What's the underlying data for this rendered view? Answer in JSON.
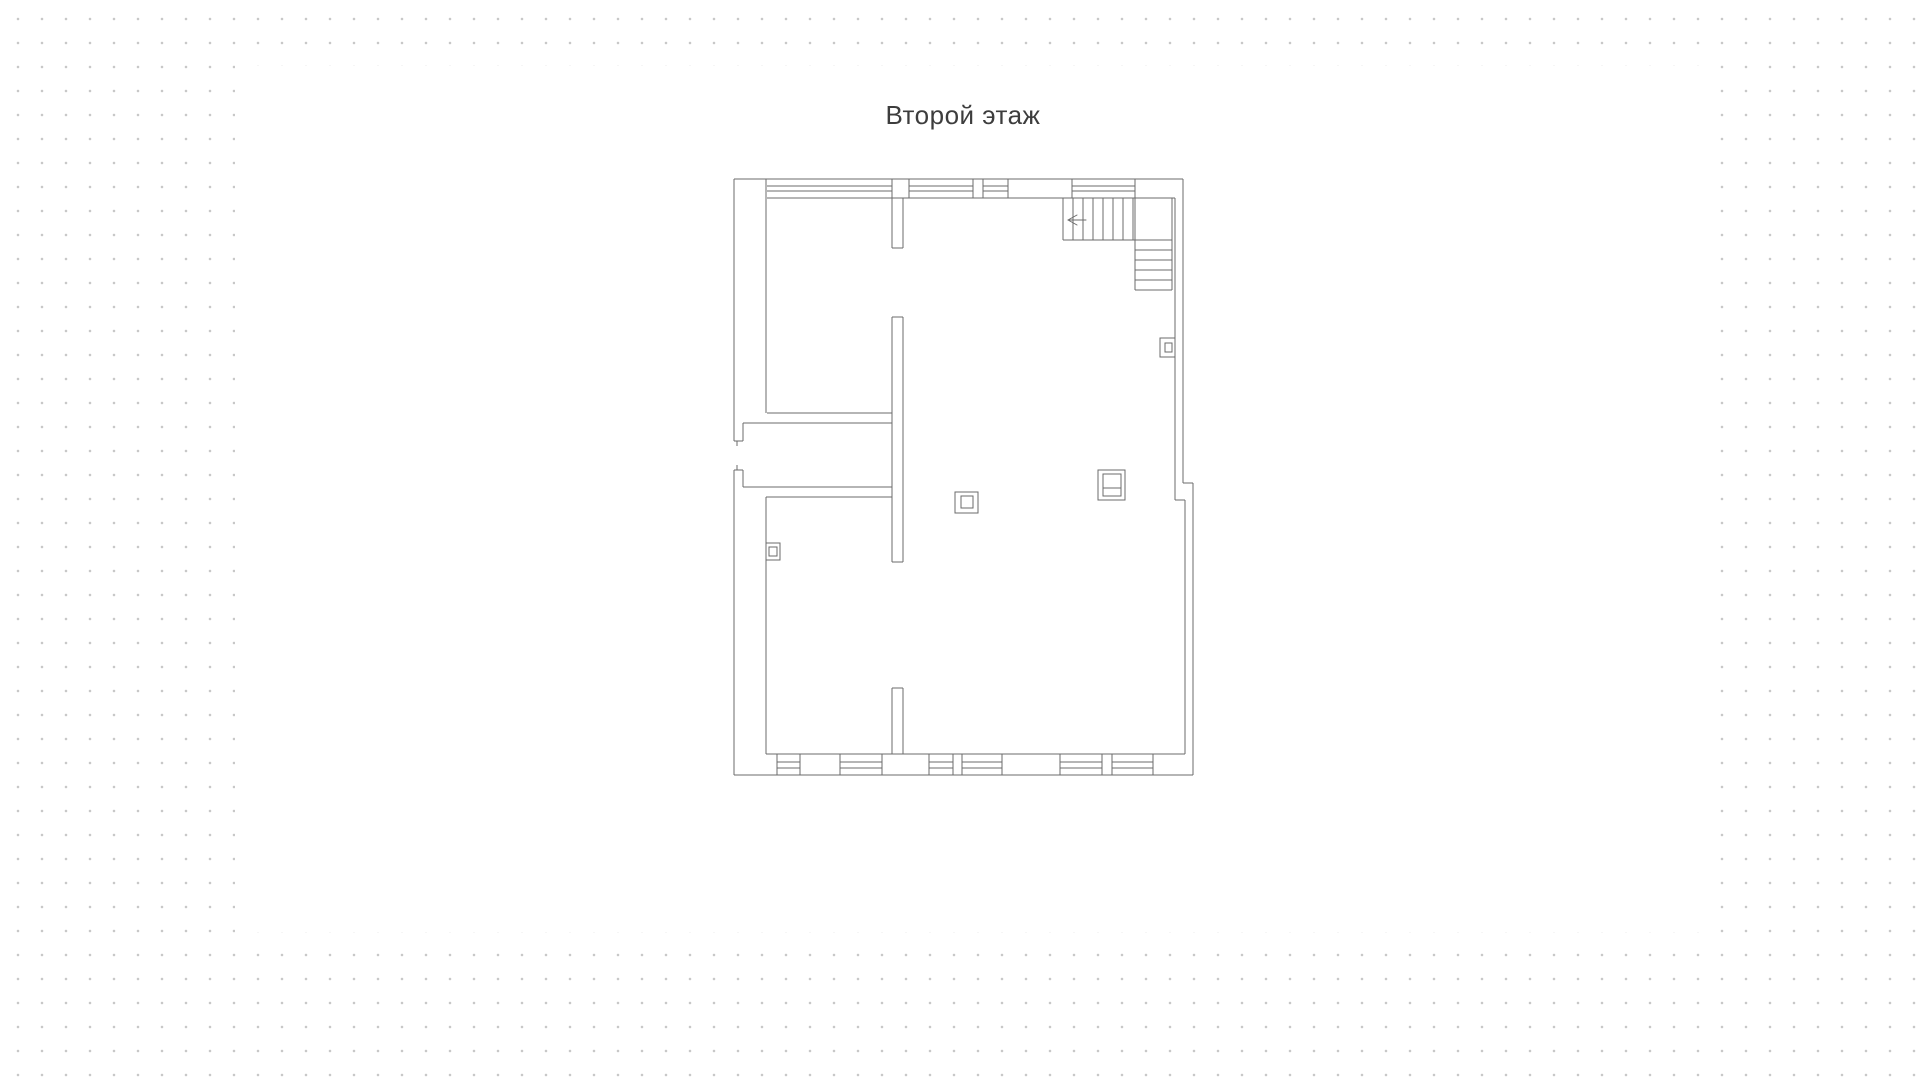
{
  "canvas": {
    "background_color": "#ffffff",
    "dot_grid": {
      "dot_color": "#c8c8c8",
      "spacing_px": 24,
      "offset_x": 6,
      "offset_y": 7
    },
    "white_area": {
      "left": 235,
      "top": 66,
      "width": 1465,
      "height": 866
    }
  },
  "floor_plan": {
    "title": "Второй этаж",
    "title_color": "#3d3d3d",
    "stroke_color": "#6b6b6b",
    "geometry": {
      "wall_lines": [
        [
          734,
          179,
          1183,
          179
        ],
        [
          1183,
          179,
          1183,
          483
        ],
        [
          1183,
          483,
          1193,
          483
        ],
        [
          1193,
          483,
          1193,
          775
        ],
        [
          734,
          775,
          1193,
          775
        ],
        [
          734,
          470,
          734,
          775
        ],
        [
          734,
          179,
          734,
          441
        ],
        [
          734,
          441,
          743,
          441
        ],
        [
          737,
          441,
          737,
          446
        ],
        [
          737,
          465,
          737,
          470
        ],
        [
          734,
          470,
          743,
          470
        ],
        [
          767,
          198,
          1175,
          198
        ],
        [
          766,
          179,
          766,
          413
        ],
        [
          909,
          179,
          909,
          198
        ],
        [
          973,
          179,
          973,
          198
        ],
        [
          983,
          179,
          983,
          198
        ],
        [
          1008,
          179,
          1008,
          198
        ],
        [
          1072,
          179,
          1072,
          198
        ],
        [
          1175,
          198,
          1175,
          338
        ],
        [
          1175,
          357,
          1175,
          500
        ],
        [
          1175,
          500,
          1185,
          500
        ],
        [
          1185,
          500,
          1185,
          754
        ],
        [
          766,
          754,
          1185,
          754
        ],
        [
          777,
          754,
          777,
          775
        ],
        [
          800,
          754,
          800,
          775
        ],
        [
          840,
          754,
          840,
          775
        ],
        [
          882,
          754,
          882,
          775
        ],
        [
          929,
          754,
          929,
          775
        ],
        [
          953,
          754,
          953,
          775
        ],
        [
          962,
          754,
          962,
          775
        ],
        [
          1002,
          754,
          1002,
          775
        ],
        [
          1060,
          754,
          1060,
          775
        ],
        [
          1102,
          754,
          1102,
          775
        ],
        [
          1112,
          754,
          1112,
          775
        ],
        [
          1153,
          754,
          1153,
          775
        ],
        [
          766,
          497,
          766,
          543
        ],
        [
          766,
          560,
          766,
          754
        ],
        [
          767,
          413,
          892,
          413
        ],
        [
          743,
          423,
          892,
          423
        ],
        [
          743,
          423,
          743,
          441
        ],
        [
          743,
          470,
          743,
          487
        ],
        [
          743,
          487,
          892,
          487
        ],
        [
          766,
          497,
          892,
          497
        ],
        [
          892,
          179,
          892,
          248
        ],
        [
          903,
          198,
          903,
          248
        ],
        [
          892,
          248,
          903,
          248
        ],
        [
          892,
          317,
          903,
          317
        ],
        [
          892,
          317,
          892,
          562
        ],
        [
          903,
          317,
          903,
          562
        ],
        [
          892,
          562,
          903,
          562
        ],
        [
          892,
          688,
          903,
          688
        ],
        [
          892,
          688,
          892,
          754
        ],
        [
          903,
          688,
          903,
          754
        ]
      ],
      "window_glass_lines": [
        [
          767,
          186,
          892,
          186
        ],
        [
          767,
          191,
          892,
          191
        ],
        [
          909,
          186,
          973,
          186
        ],
        [
          909,
          191,
          973,
          191
        ],
        [
          983,
          186,
          1008,
          186
        ],
        [
          983,
          191,
          1008,
          191
        ],
        [
          1072,
          186,
          1135,
          186
        ],
        [
          1072,
          191,
          1135,
          191
        ],
        [
          777,
          762,
          800,
          762
        ],
        [
          777,
          768,
          800,
          768
        ],
        [
          840,
          762,
          882,
          762
        ],
        [
          840,
          768,
          882,
          768
        ],
        [
          929,
          762,
          953,
          762
        ],
        [
          929,
          768,
          953,
          768
        ],
        [
          962,
          762,
          1002,
          762
        ],
        [
          962,
          768,
          1002,
          768
        ],
        [
          1060,
          762,
          1102,
          762
        ],
        [
          1060,
          768,
          1102,
          768
        ],
        [
          1112,
          762,
          1153,
          762
        ],
        [
          1112,
          768,
          1153,
          768
        ]
      ],
      "stair_lines": [
        [
          1063,
          198,
          1063,
          240
        ],
        [
          1063,
          240,
          1135,
          240
        ],
        [
          1135,
          179,
          1135,
          290
        ],
        [
          1172,
          198,
          1172,
          290
        ],
        [
          1135,
          240,
          1172,
          240
        ],
        [
          1135,
          250,
          1172,
          250
        ],
        [
          1135,
          260,
          1172,
          260
        ],
        [
          1135,
          270,
          1172,
          270
        ],
        [
          1135,
          280,
          1172,
          280
        ],
        [
          1135,
          290,
          1172,
          290
        ],
        [
          1073,
          198,
          1073,
          240
        ],
        [
          1083,
          198,
          1083,
          240
        ],
        [
          1093,
          198,
          1093,
          240
        ],
        [
          1103,
          198,
          1103,
          240
        ],
        [
          1113,
          198,
          1113,
          240
        ],
        [
          1123,
          198,
          1123,
          240
        ],
        [
          1133,
          198,
          1133,
          240
        ]
      ],
      "stair_arrow_lines": [
        [
          1086,
          220,
          1068,
          220
        ],
        [
          1068,
          220,
          1077,
          215
        ],
        [
          1068,
          220,
          1077,
          225
        ]
      ],
      "flue_rects": [
        [
          766,
          543,
          14,
          17
        ],
        [
          769,
          547,
          8,
          9
        ],
        [
          1160,
          338,
          15,
          19
        ],
        [
          1165,
          343,
          7,
          9
        ],
        [
          955,
          492,
          23,
          21
        ],
        [
          961,
          496,
          12,
          12
        ],
        [
          1098,
          470,
          27,
          30
        ],
        [
          1103,
          474,
          18,
          22
        ]
      ],
      "flue_divider_lines": [
        [
          1103,
          488,
          1121,
          488
        ]
      ]
    }
  }
}
